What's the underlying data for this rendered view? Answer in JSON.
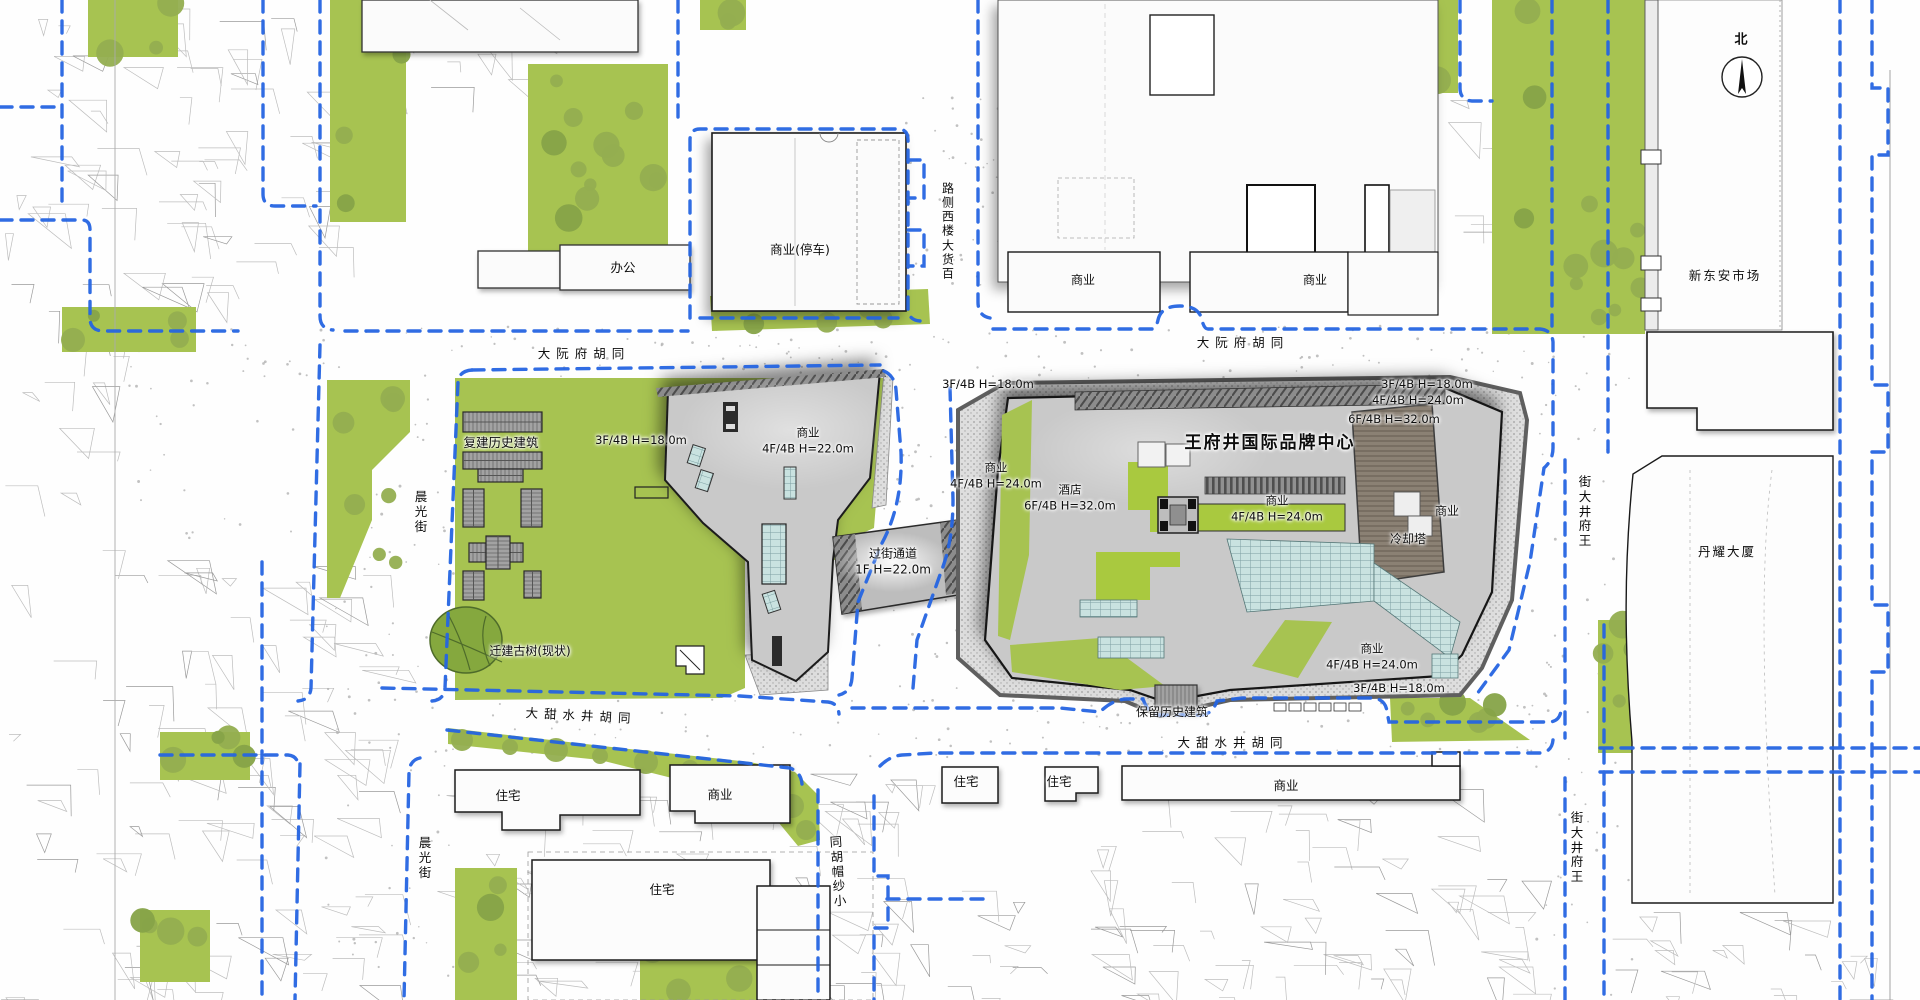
{
  "colors": {
    "boundary_blue": "#2565e2",
    "site_green": "#a7c351",
    "bright_green": "#a9c93f",
    "tree_green": "#8fab4d",
    "building_gray": "#c9c9c9",
    "roof_brown": "#8b8174",
    "skylight_teal": "#c9e2e0",
    "historic_roof_gray": "#a2a2a2"
  },
  "labels": [
    {
      "id": "north",
      "text": "北"
    },
    {
      "id": "xindongan-market",
      "text": "新东安市场"
    },
    {
      "id": "danyao-tower",
      "text": "丹耀大厦"
    },
    {
      "id": "office",
      "text": "办公"
    },
    {
      "id": "commercial-parking",
      "text": "商业(停车)"
    },
    {
      "id": "commercial-nw",
      "text": "商业"
    },
    {
      "id": "commercial-ne",
      "text": "商业"
    },
    {
      "id": "baihuo-west-road",
      "text": "百货大楼西侧路"
    },
    {
      "id": "dayuanfu-hutong-w",
      "text": "大阮府胡同"
    },
    {
      "id": "dayuanfu-hutong-e",
      "text": "大阮府胡同"
    },
    {
      "id": "rebuilt-historic",
      "text": "复建历史建筑"
    },
    {
      "id": "h-left-site",
      "text": "3F/4B H=18.0m"
    },
    {
      "id": "left-commercial",
      "text": "商业\n4F/4B H=22.0m"
    },
    {
      "id": "h-right-nw",
      "text": "3F/4B H=18.0m"
    },
    {
      "id": "right-west-commercial",
      "text": "商业\n4F/4B H=24.0m"
    },
    {
      "id": "project-title",
      "text": "王府井国际品牌中心"
    },
    {
      "id": "hotel",
      "text": "酒店\n6F/4B H=32.0m"
    },
    {
      "id": "center-commercial",
      "text": "商业\n4F/4B H=24.0m"
    },
    {
      "id": "h-ne-1",
      "text": "3F/4B H=18.0m"
    },
    {
      "id": "h-ne-2",
      "text": "4F/4B H=24.0m"
    },
    {
      "id": "h-ne-3",
      "text": "6F/4B H=32.0m"
    },
    {
      "id": "cooling-tower",
      "text": "冷却塔"
    },
    {
      "id": "east-commercial",
      "text": "商业"
    },
    {
      "id": "se-commercial",
      "text": "商业\n4F/4B H=24.0m"
    },
    {
      "id": "h-se",
      "text": "3F/4B H=18.0m"
    },
    {
      "id": "preserved-historic",
      "text": "保留历史建筑"
    },
    {
      "id": "crossing-passage",
      "text": "过街通道\n1F H=22.0m"
    },
    {
      "id": "relocated-tree",
      "text": "迁建古树(现状)"
    },
    {
      "id": "datianshuijing-hutong-w",
      "text": "大甜水井胡同"
    },
    {
      "id": "datianshuijing-hutong-e",
      "text": "大甜水井胡同"
    },
    {
      "id": "residential-1",
      "text": "住宅"
    },
    {
      "id": "commercial-s1",
      "text": "商业"
    },
    {
      "id": "residential-2",
      "text": "住宅"
    },
    {
      "id": "residential-3",
      "text": "住宅"
    },
    {
      "id": "commercial-s2",
      "text": "商业"
    },
    {
      "id": "residential-4",
      "text": "住宅"
    },
    {
      "id": "chenguang-st-n",
      "text": "晨光街"
    },
    {
      "id": "chenguang-st-s",
      "text": "晨光街"
    },
    {
      "id": "xiaoshamao-hutong",
      "text": "小纱帽胡同"
    },
    {
      "id": "wangfujing-st-n",
      "text": "王府井大街"
    },
    {
      "id": "wangfujing-st-s",
      "text": "王府井大街"
    }
  ]
}
